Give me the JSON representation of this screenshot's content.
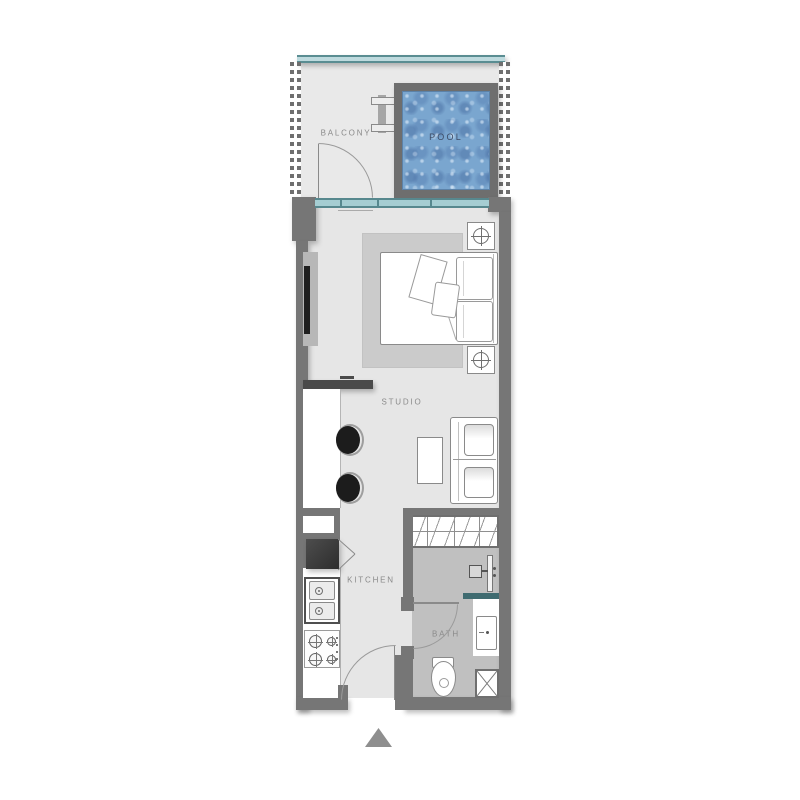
{
  "floorplan": {
    "labels": {
      "balcony": "BALCONY",
      "pool": "POOL",
      "studio": "STUDIO",
      "kitchen": "KITCHEN",
      "bath": "BATH"
    },
    "colors": {
      "wall": "#767676",
      "floor": "#e6e6e6",
      "bath_floor": "#c0c0c0",
      "rug": "#cbcbcb",
      "glass": "#a5cdd2",
      "glass_edge": "#57888e",
      "pool_water": "#7aa6cf",
      "pool_frame": "#6e6e6e",
      "label_text": "#8a8a8a",
      "pool_label_text": "#3e4c66",
      "fridge": "#3a3a3a",
      "bar_stool": "#1c1c1c",
      "entry_marker": "#8e8e8e"
    },
    "entry_marker_icon": "triangle-up"
  }
}
